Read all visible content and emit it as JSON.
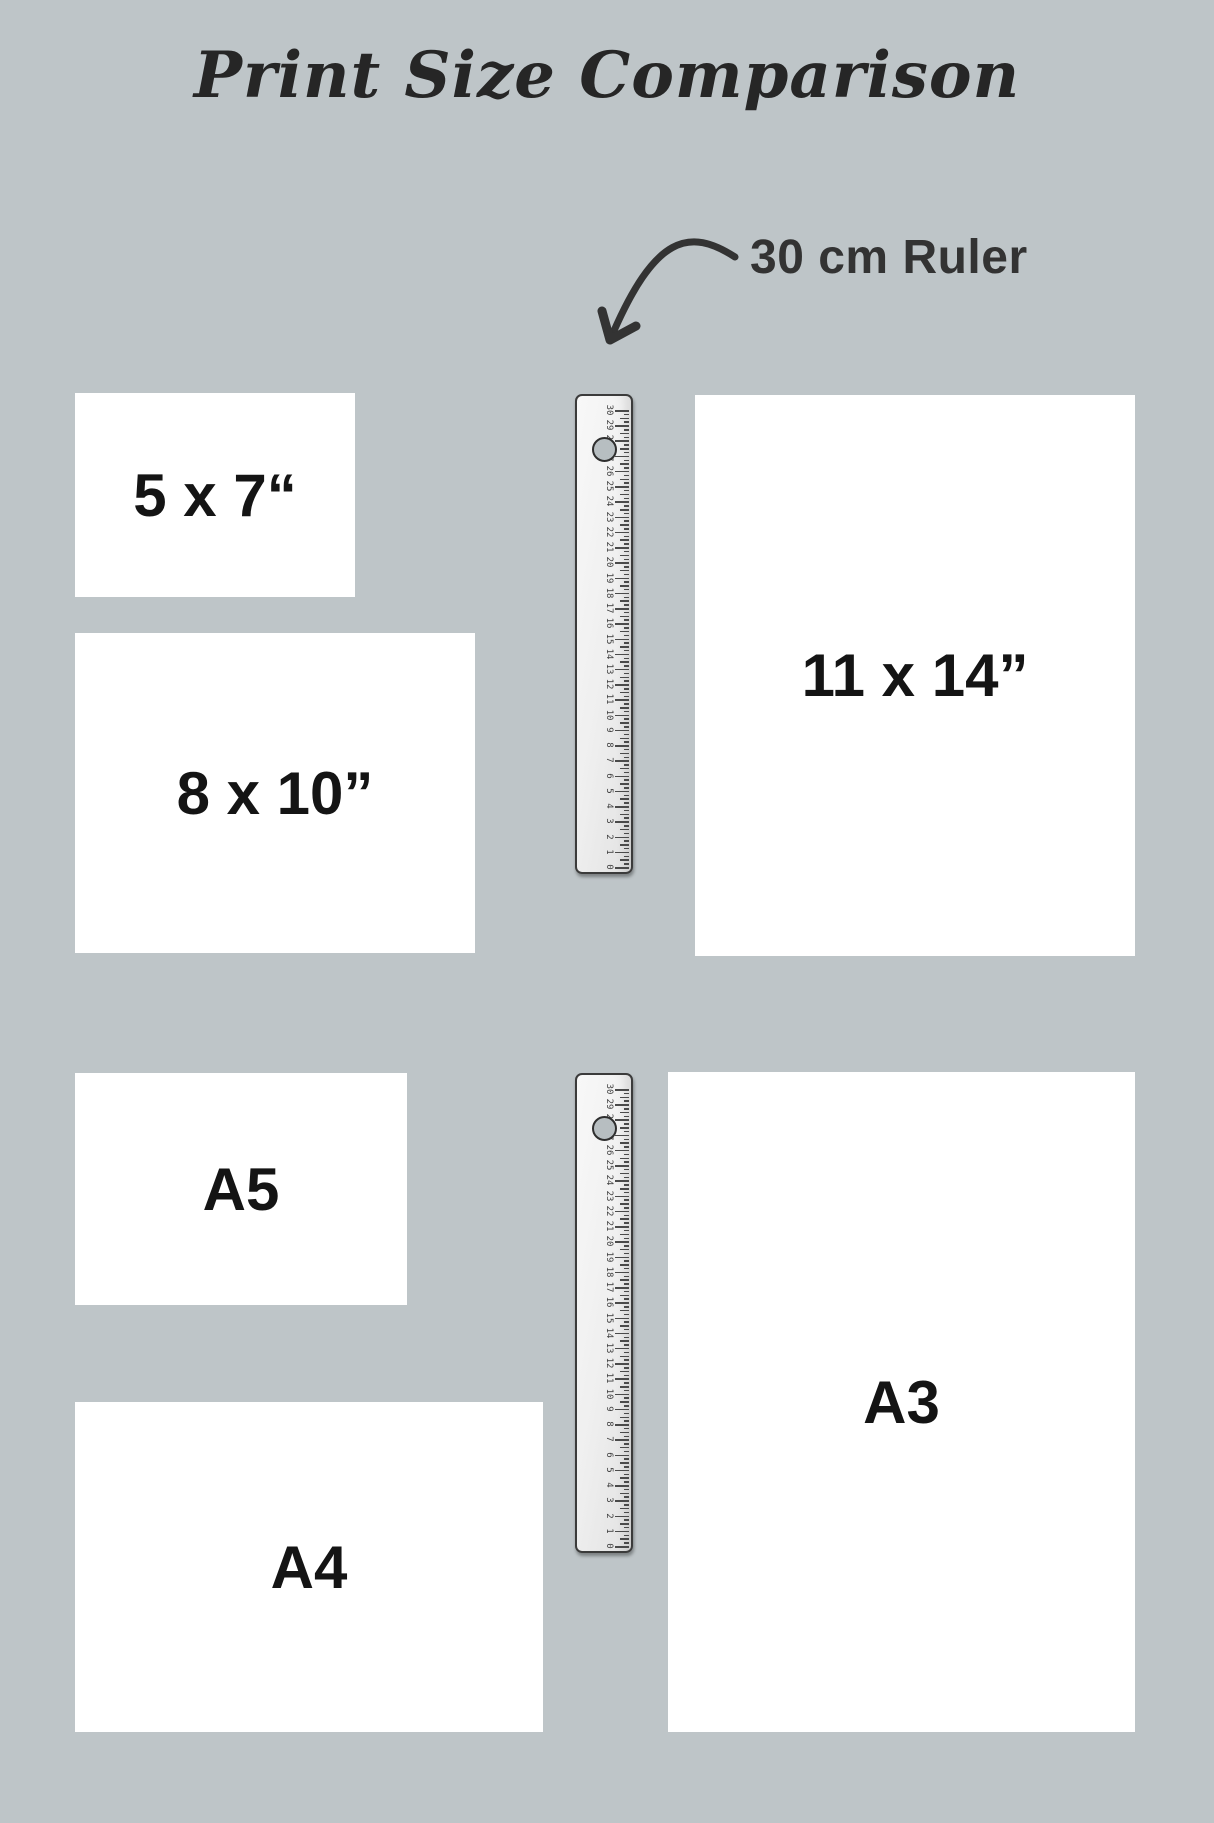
{
  "title": {
    "text": "Print Size Comparison"
  },
  "annotation": {
    "text": "30 cm Ruler"
  },
  "colors": {
    "background": "#bec5c8",
    "paper": "#ffffff",
    "label_text": "#141414",
    "title_text": "#262626",
    "annotation_text": "#333333",
    "arrow": "#333333",
    "ruler_border": "#3b3b3b",
    "ruler_tick": "#4a4a4a"
  },
  "papers": [
    {
      "id": "5x7",
      "label": "5 x 7“",
      "x": 75,
      "y": 393,
      "w": 280,
      "h": 204
    },
    {
      "id": "8x10",
      "label": "8 x 10”",
      "x": 75,
      "y": 633,
      "w": 400,
      "h": 320
    },
    {
      "id": "11x14",
      "label": "11 x 14”",
      "x": 695,
      "y": 395,
      "w": 440,
      "h": 561
    },
    {
      "id": "a5",
      "label": "A5",
      "x": 75,
      "y": 1073,
      "w": 332,
      "h": 232
    },
    {
      "id": "a4",
      "label": "A4",
      "x": 75,
      "y": 1402,
      "w": 468,
      "h": 330
    },
    {
      "id": "a3",
      "label": "A3",
      "x": 668,
      "y": 1072,
      "w": 467,
      "h": 660
    }
  ],
  "ruler_spec": {
    "unit": "cm",
    "cm_min": 0,
    "cm_max": 30,
    "numbers": [
      0,
      1,
      2,
      3,
      4,
      5,
      6,
      7,
      8,
      9,
      10,
      11,
      12,
      13,
      14,
      15,
      16,
      17,
      18,
      19,
      20,
      21,
      22,
      23,
      24,
      25,
      26,
      27,
      28,
      29,
      30
    ],
    "hole_cm": 27.5
  },
  "rulers": [
    {
      "id": "ruler-top",
      "x": 575,
      "y": 394,
      "w": 58,
      "h": 480
    },
    {
      "id": "ruler-bottom",
      "x": 575,
      "y": 1073,
      "w": 58,
      "h": 480
    }
  ]
}
